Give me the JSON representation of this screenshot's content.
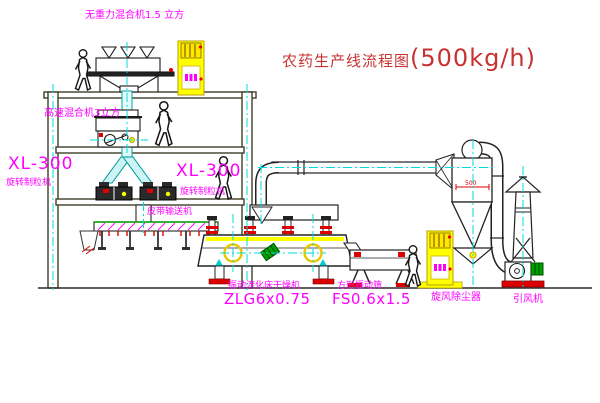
{
  "title": {
    "name_cn": "农药生产线流程图",
    "capacity": "(500kg/h)"
  },
  "labels": {
    "top_mixer": "无重力混合机1.5 立方",
    "high_speed_mixer": "高速混合机3立方",
    "granulator_left": {
      "model": "XL-300",
      "name": "旋转制粒机"
    },
    "granulator_center": {
      "model": "XL-300",
      "name": "旋转制粒机"
    },
    "belt_conveyor": "皮带输送机",
    "dryer": {
      "name": "振动流化床干燥机",
      "model": "ZLG6x0.75"
    },
    "screen": {
      "name": "方形振动筛",
      "model": "FS0.6x1.5"
    },
    "cyclone": "旋风除尘器",
    "cyclone_dim": "500",
    "fan": "引风机"
  },
  "colors": {
    "annotation_magenta": "#ff00ff",
    "title_red": "#c83232",
    "structure_olive": "#3f3f28",
    "centerline_cyan": "#00dcdc",
    "equipment_yellow": "#ffff00",
    "alert_red": "#dd0000",
    "motor_green": "#00a000",
    "background": "#ffffff"
  },
  "icons": {
    "person_figure": "walking-worker-silhouette",
    "control_cabinet": "electric-control-cabinet",
    "up_arrow": "cyan-vibration-arrow"
  }
}
